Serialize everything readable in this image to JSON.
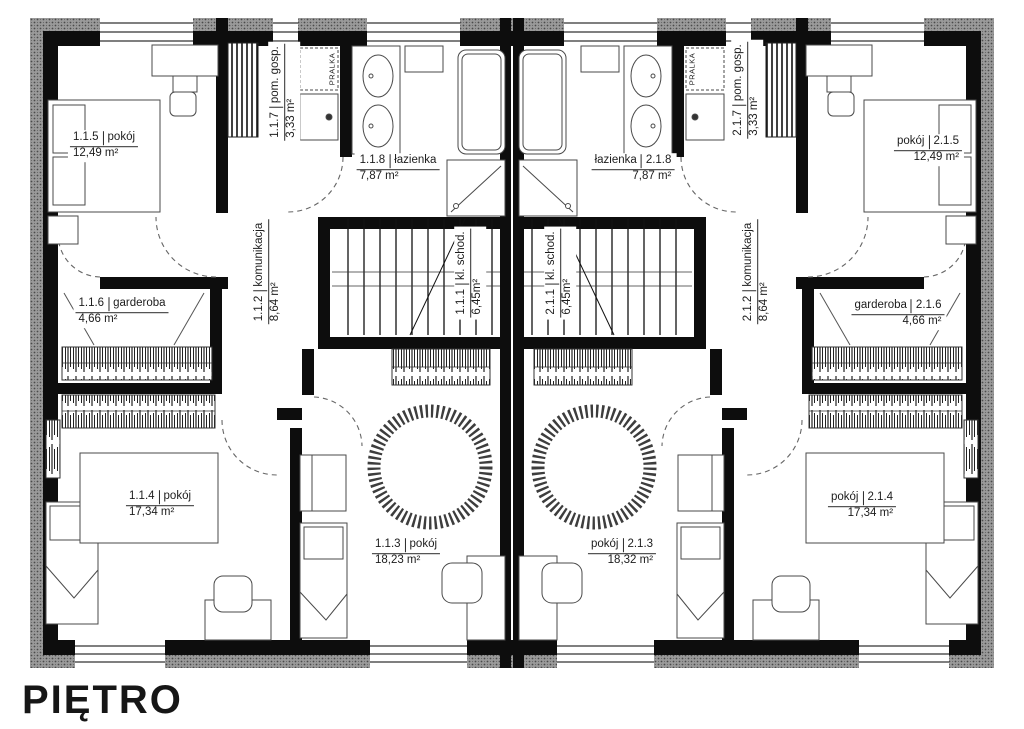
{
  "title": "PIĘTRO",
  "colors": {
    "wall": "#0d0d0d",
    "insulation": "#999999",
    "furniture_line": "#4a4a4a",
    "label_text": "#1c1c1c"
  },
  "plan": {
    "pralka": "PRALKA",
    "rooms": [
      {
        "id": "1.1.5",
        "name": "pokój",
        "area": "12,49 m²"
      },
      {
        "id": "1.1.7",
        "name": "pom. gosp.",
        "area": "3,33 m²"
      },
      {
        "id": "1.1.8",
        "name": "łazienka",
        "area": "7,87 m²"
      },
      {
        "id": "1.1.2",
        "name": "komunikacja",
        "area": "8,64 m²"
      },
      {
        "id": "1.1.1",
        "name": "kl. schod.",
        "area": "6,45m²"
      },
      {
        "id": "1.1.6",
        "name": "garderoba",
        "area": "4,66 m²"
      },
      {
        "id": "1.1.4",
        "name": "pokój",
        "area": "17,34 m²"
      },
      {
        "id": "1.1.3",
        "name": "pokój",
        "area": "18,23 m²"
      },
      {
        "id": "2.1.1",
        "name": "kl. schod.",
        "area": "6,45m²"
      },
      {
        "id": "2.1.2",
        "name": "komunikacja",
        "area": "8,64 m²"
      },
      {
        "id": "2.1.8",
        "name": "łazienka",
        "area": "7,87 m²"
      },
      {
        "id": "2.1.7",
        "name": "pom. gosp.",
        "area": "3,33 m²"
      },
      {
        "id": "2.1.5",
        "name": "pokój",
        "area": "12,49 m²"
      },
      {
        "id": "2.1.6",
        "name": "garderoba",
        "area": "4,66 m²"
      },
      {
        "id": "2.1.4",
        "name": "pokój",
        "area": "17,34 m²"
      },
      {
        "id": "2.1.3",
        "name": "pokój",
        "area": "18,32 m²"
      }
    ]
  }
}
